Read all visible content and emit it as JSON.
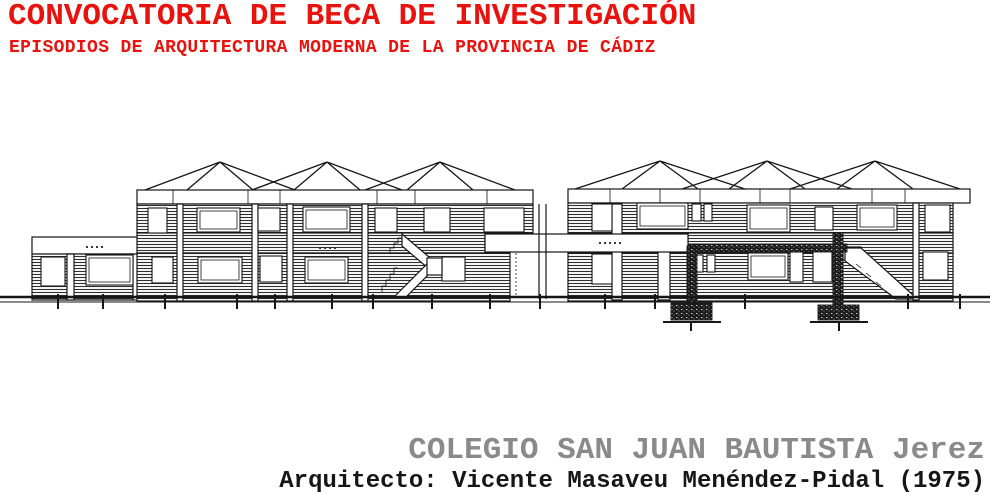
{
  "header": {
    "title": "CONVOCATORIA DE BECA DE INVESTIGACIÓN",
    "subtitle": "EPISODIOS DE ARQUITECTURA MODERNA DE LA PROVINCIA DE CÁDIZ"
  },
  "figure": {
    "label": "elevation-drawing"
  },
  "footer": {
    "building": "COLEGIO SAN JUAN BAUTISTA Jerez",
    "architect": "Arquitecto: Vicente Masaveu Menéndez-Pidal (1975)"
  },
  "colors": {
    "accent-red": "#e8130e",
    "caption-gray": "#8a8a8a",
    "ink": "#161616"
  }
}
